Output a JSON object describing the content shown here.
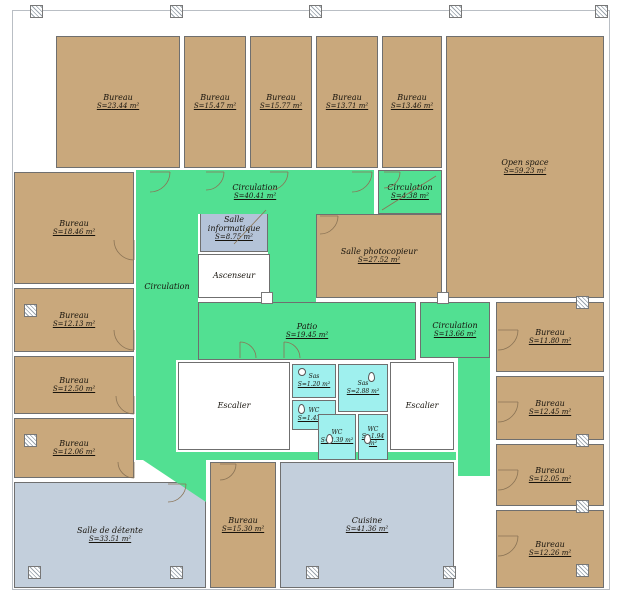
{
  "plan": {
    "title": "Floor plan",
    "colors": {
      "tan": "#C9A87C",
      "green": "#52E092",
      "cyan": "#9FF0EE",
      "slate": "#B4C3D8",
      "paleblue": "#C3CFDC",
      "white": "#FFFFFF",
      "wall": "#6F6F6F"
    },
    "rooms": [
      {
        "id": "bureau-2344",
        "name": "Bureau",
        "area": "S=23.44 m²",
        "color": "tan"
      },
      {
        "id": "bureau-1547",
        "name": "Bureau",
        "area": "S=15.47 m²",
        "color": "tan"
      },
      {
        "id": "bureau-1577",
        "name": "Bureau",
        "area": "S=15.77 m²",
        "color": "tan"
      },
      {
        "id": "bureau-1371",
        "name": "Bureau",
        "area": "S=13.71 m²",
        "color": "tan"
      },
      {
        "id": "bureau-1346",
        "name": "Bureau",
        "area": "S=13.46 m²",
        "color": "tan"
      },
      {
        "id": "open-space",
        "name": "Open space",
        "area": "S=59.23 m²",
        "color": "tan"
      },
      {
        "id": "bureau-1846",
        "name": "Bureau",
        "area": "S=18.46 m²",
        "color": "tan"
      },
      {
        "id": "bureau-1213",
        "name": "Bureau",
        "area": "S=12.13 m²",
        "color": "tan"
      },
      {
        "id": "bureau-1250",
        "name": "Bureau",
        "area": "S=12.50 m²",
        "color": "tan"
      },
      {
        "id": "bureau-1206",
        "name": "Bureau",
        "area": "S=12.06 m²",
        "color": "tan"
      },
      {
        "id": "salle-detente",
        "name": "Salle de détente",
        "area": "S=33.51 m²",
        "color": "paleblue"
      },
      {
        "id": "bureau-1530",
        "name": "Bureau",
        "area": "S=15.30 m²",
        "color": "tan"
      },
      {
        "id": "cuisine",
        "name": "Cuisine",
        "area": "S=41.36 m²",
        "color": "paleblue"
      },
      {
        "id": "bureau-1180",
        "name": "Bureau",
        "area": "S=11.80 m²",
        "color": "tan"
      },
      {
        "id": "bureau-1245",
        "name": "Bureau",
        "area": "S=12.45 m²",
        "color": "tan"
      },
      {
        "id": "bureau-1205",
        "name": "Bureau",
        "area": "S=12.05 m²",
        "color": "tan"
      },
      {
        "id": "bureau-1226",
        "name": "Bureau",
        "area": "S=12.26 m²",
        "color": "tan"
      },
      {
        "id": "salle-informatique",
        "name": "Salle informatique",
        "area": "S=8.75 m²",
        "color": "slate"
      },
      {
        "id": "ascenseur",
        "name": "Ascenseur",
        "area": "",
        "color": "white"
      },
      {
        "id": "salle-photocopieur",
        "name": "Salle photocopieur",
        "area": "S=27.52 m²",
        "color": "tan"
      },
      {
        "id": "circulation-top",
        "name": "Circulation",
        "area": "S=40.41 m²",
        "color": "green"
      },
      {
        "id": "circulation-438",
        "name": "Circulation",
        "area": "S=4.38 m²",
        "color": "green"
      },
      {
        "id": "circulation-left",
        "name": "Circulation",
        "area": "",
        "color": "green"
      },
      {
        "id": "patio",
        "name": "Patio",
        "area": "S=19.45 m²",
        "color": "green"
      },
      {
        "id": "circulation-1366",
        "name": "Circulation",
        "area": "S=13.66 m²",
        "color": "green"
      },
      {
        "id": "escalier-left",
        "name": "Escalier",
        "area": "",
        "color": "white"
      },
      {
        "id": "escalier-right",
        "name": "Escalier",
        "area": "",
        "color": "white"
      },
      {
        "id": "sas-120",
        "name": "Sas",
        "area": "S=1.20 m²",
        "color": "cyan"
      },
      {
        "id": "sas-288",
        "name": "Sas",
        "area": "S=2.88 m²",
        "color": "cyan"
      },
      {
        "id": "wc-143",
        "name": "WC",
        "area": "S=1.43 m²",
        "color": "cyan"
      },
      {
        "id": "wc-239",
        "name": "WC",
        "area": "S=2.39 m²",
        "color": "cyan"
      },
      {
        "id": "wc-194",
        "name": "WC",
        "area": "S=1.94 m²",
        "color": "cyan"
      }
    ]
  }
}
